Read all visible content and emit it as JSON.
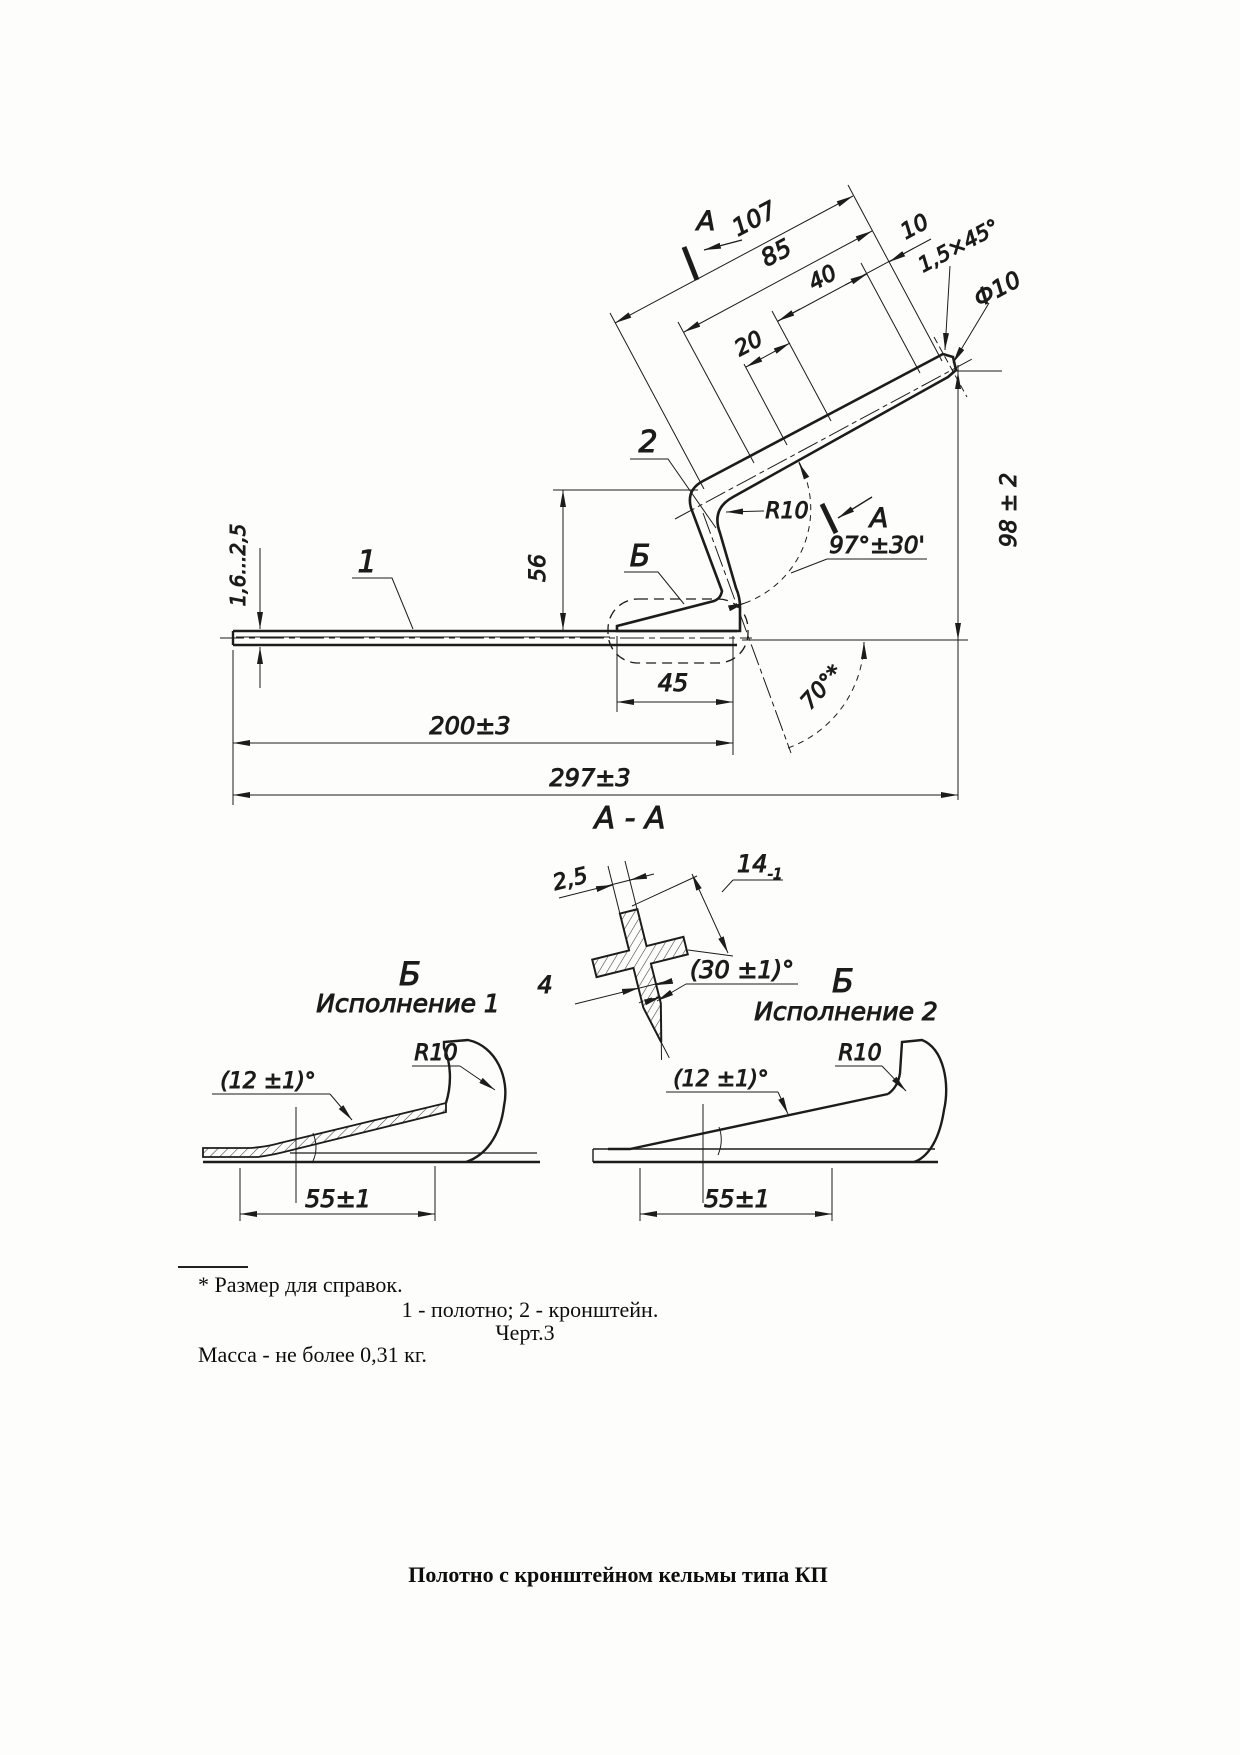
{
  "main_view": {
    "section_letter": "А",
    "part_labels": {
      "blade": "1",
      "bracket": "2"
    },
    "detail_marker": "Б",
    "dims": {
      "len107": "107",
      "len85": "85",
      "len40": "40",
      "len20": "20",
      "len10": "10",
      "chamfer": "1,5×45°",
      "diameter": "Ф10",
      "thickness": "1,6...2,5",
      "height56": "56",
      "radius": "R10",
      "angle97": "97°±30'",
      "len45": "45",
      "len200": "200±3",
      "len297": "297±3",
      "angle70": "70°*",
      "height98": "98 ± 2"
    }
  },
  "section_aa": {
    "title": "А - А",
    "rib_thickness": "2,5",
    "overall": "14",
    "overall_tol": "-1",
    "width4": "4",
    "angle30": "(30 ±1)°"
  },
  "detail1": {
    "marker": "Б",
    "variant": "Исполнение 1",
    "radius": "R10",
    "angle12": "(12 ±1)°",
    "len55": "55±1"
  },
  "detail2": {
    "marker": "Б",
    "variant": "Исполнение 2",
    "radius": "R10",
    "angle12": "(12 ±1)°",
    "len55": "55±1"
  },
  "notes": {
    "reference": "* Размер для справок.",
    "legend": "1 - полотно; 2 - кронштейн.",
    "figure": "Черт.3",
    "mass": "Масса - не более 0,31 кг."
  },
  "caption": "Полотно с кронштейном кельмы типа КП"
}
